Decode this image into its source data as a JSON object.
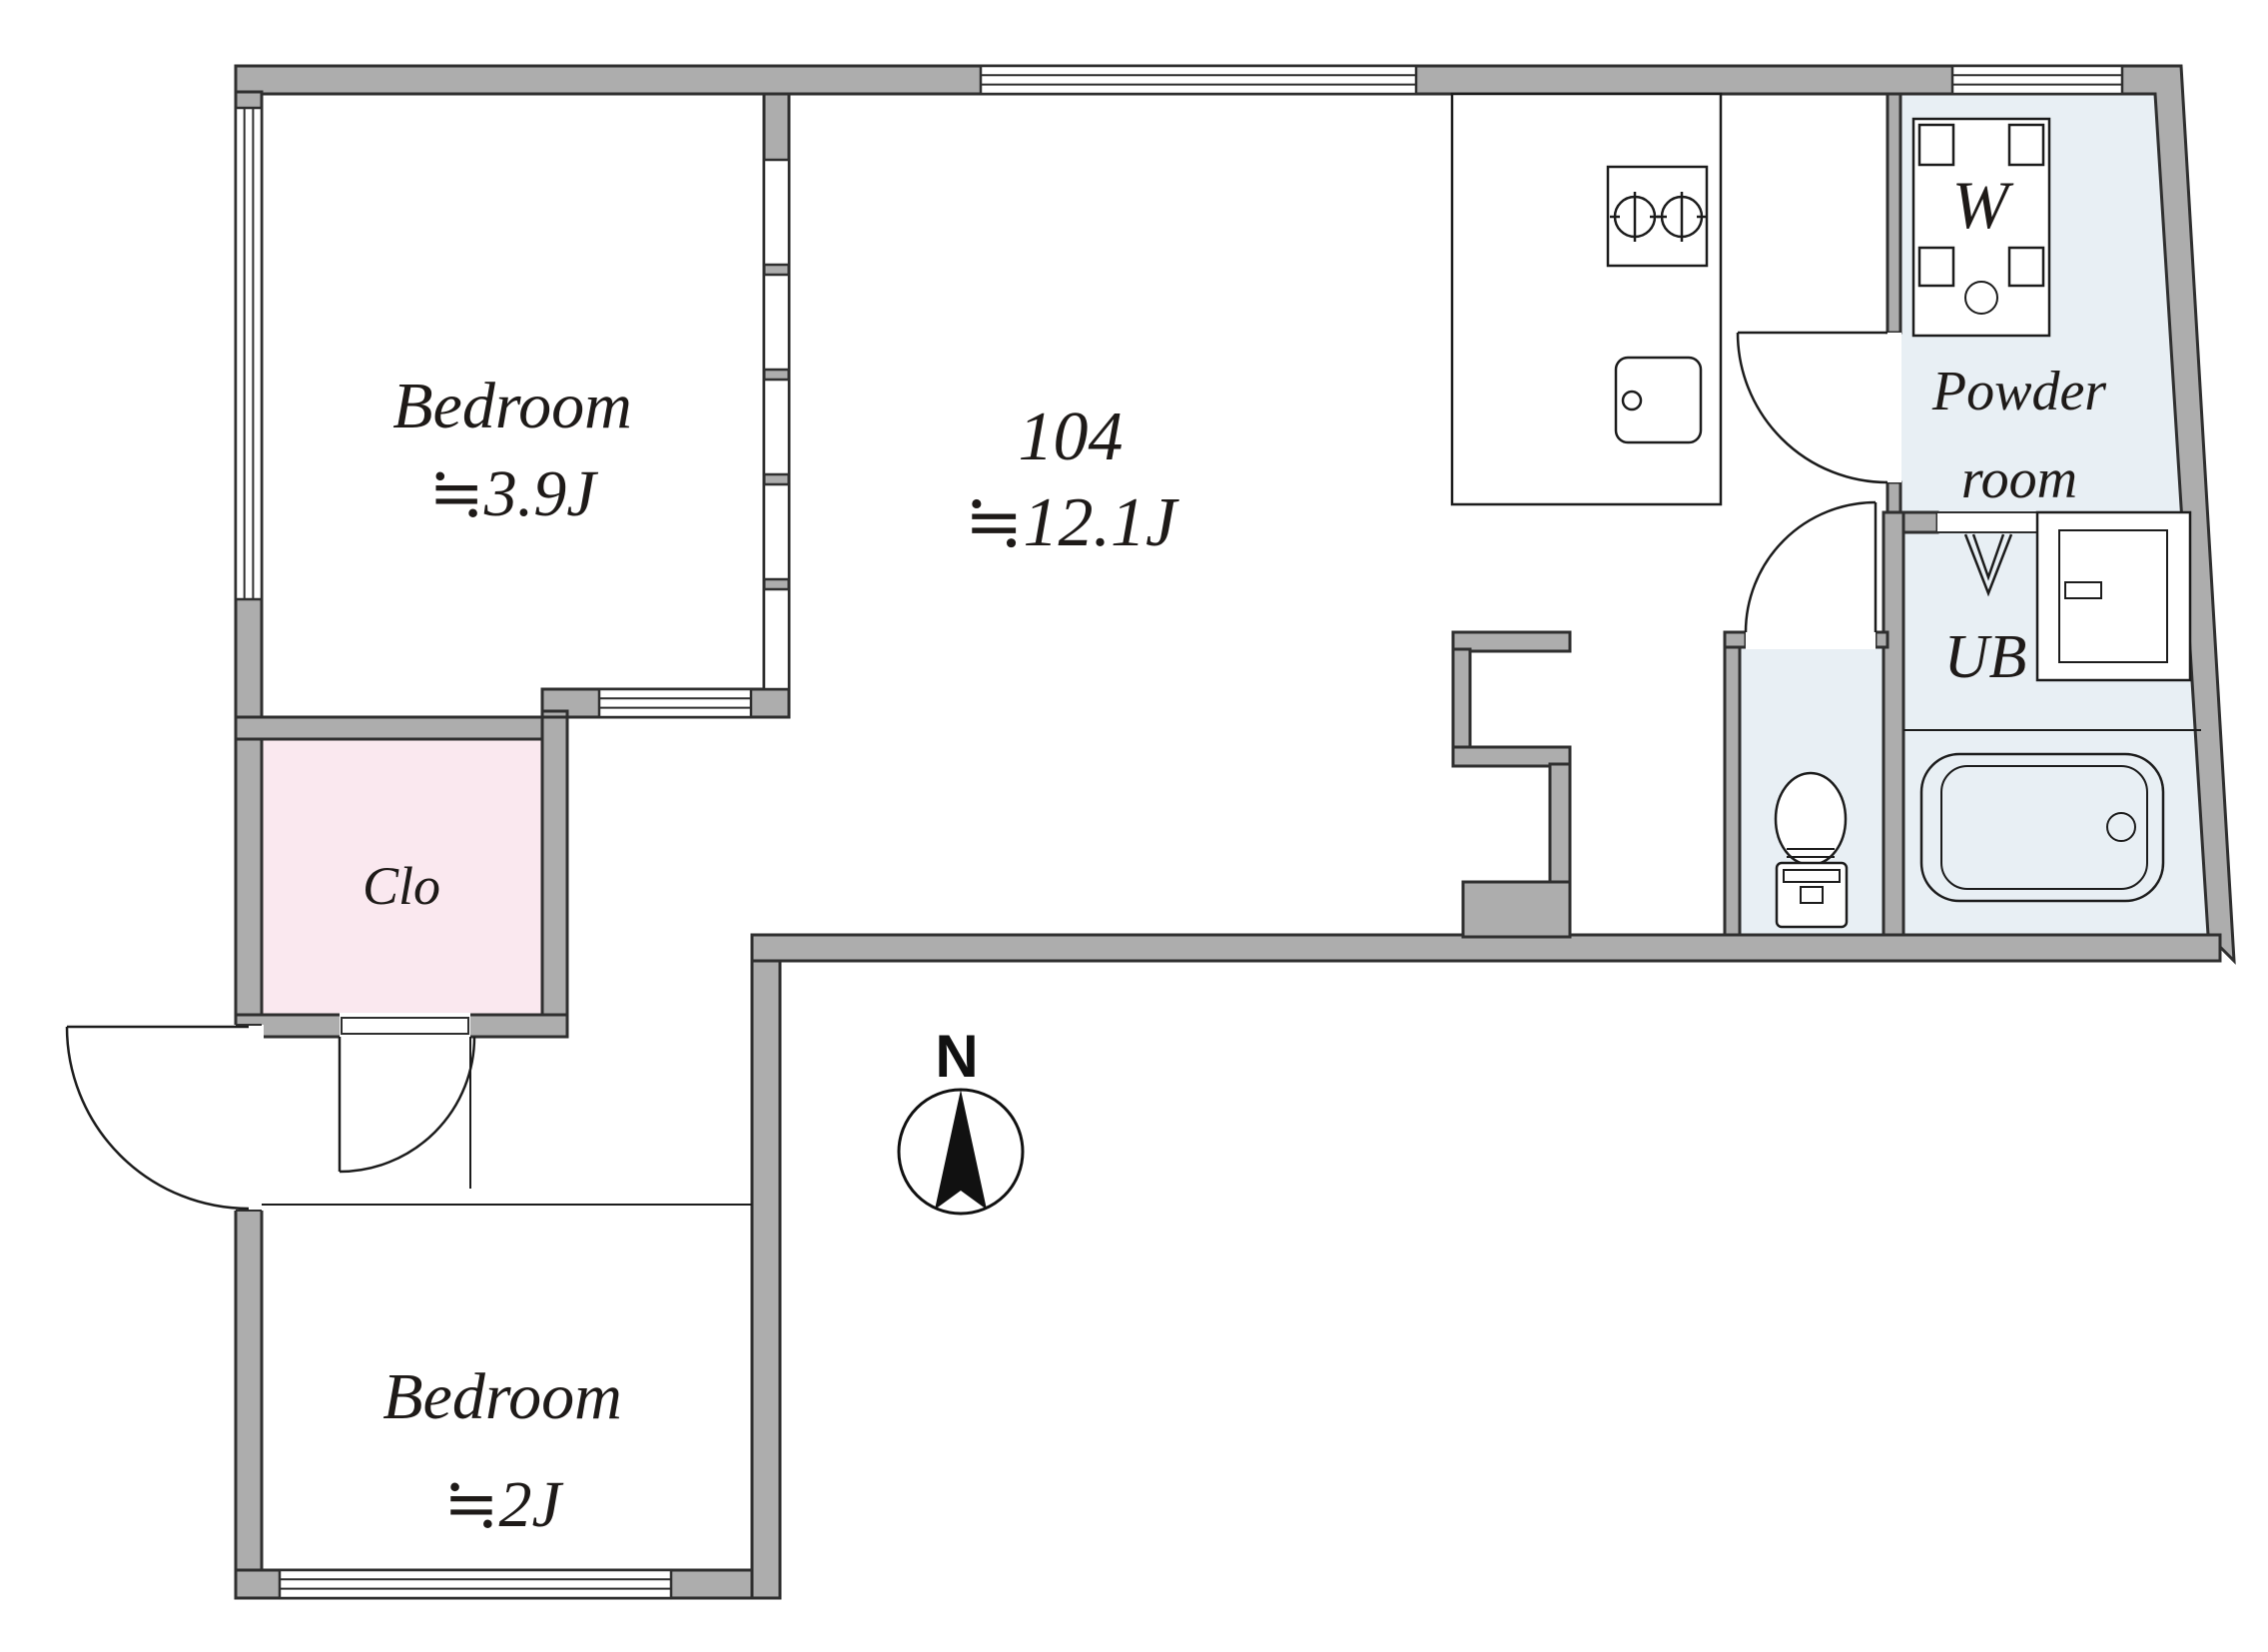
{
  "plan": {
    "unit_number": "104",
    "rooms": {
      "main": {
        "number": "104",
        "area": "≒12.1J"
      },
      "bedroom1": {
        "name": "Bedroom",
        "area": "≒3.9J"
      },
      "bedroom2": {
        "name": "Bedroom",
        "area": "≒2J"
      },
      "closet": {
        "label": "Clo"
      },
      "powder": {
        "line1": "Powder",
        "line2": "room"
      },
      "unit_bath": {
        "label": "UB"
      },
      "washer_label": "W"
    },
    "compass": {
      "north_label": "N"
    },
    "colors": {
      "wall_fill": "#adadad",
      "wall_outline": "#2f2f2f",
      "closet_floor": "#fae8ef",
      "wet_area_floor": "#e8eff4",
      "line": "#1c1c1c",
      "background": "#ffffff"
    },
    "fixtures": [
      "kitchen-counter",
      "stove-2-burner",
      "kitchen-sink",
      "washing-machine-pan",
      "vanity-cabinet",
      "folding-door-symbol",
      "bathtub",
      "toilet",
      "compass-rose"
    ]
  }
}
